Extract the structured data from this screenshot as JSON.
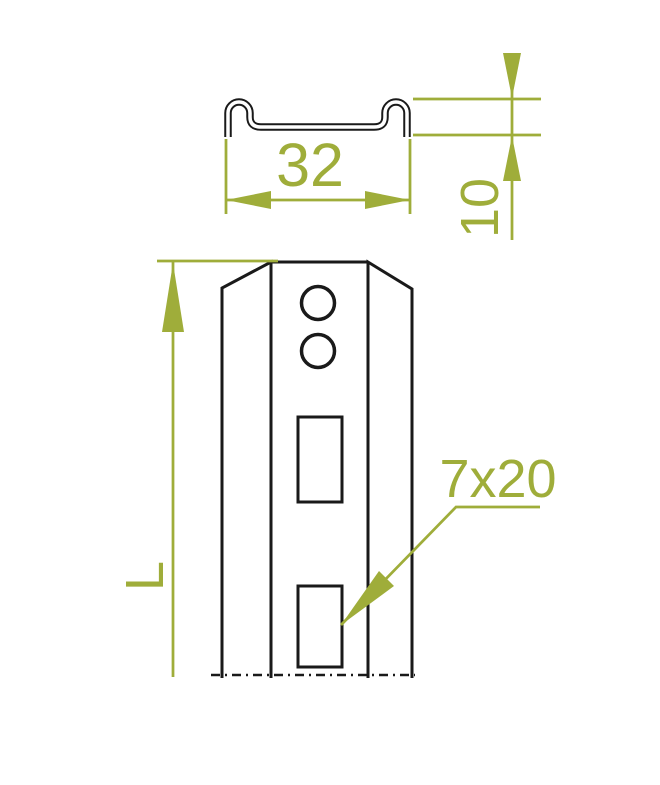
{
  "drawing": {
    "labels": {
      "profile_width": "32",
      "profile_height": "10",
      "part_length": "L",
      "slot_size": "7x20"
    },
    "colors": {
      "dimension": "#9FAD3A",
      "outline": "#1A1A1A",
      "background": "#FFFFFF"
    }
  }
}
